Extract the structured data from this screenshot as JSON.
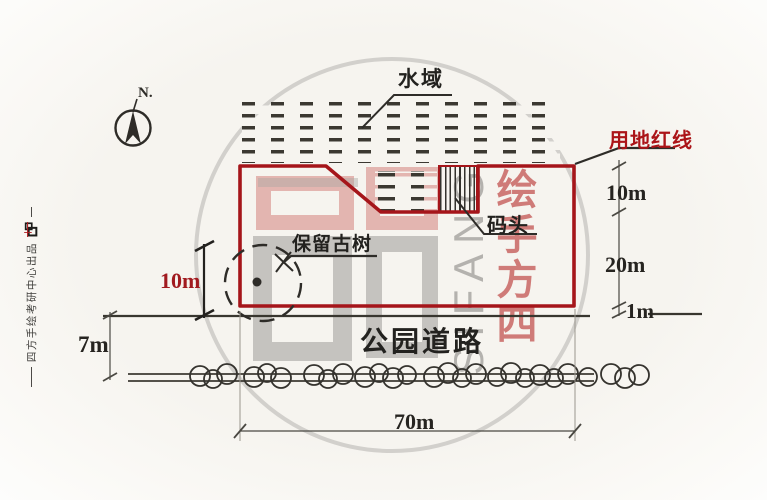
{
  "canvas": {
    "width": 767,
    "height": 500
  },
  "compass": {
    "north_label": "N."
  },
  "plan_labels": {
    "water_area": "水域",
    "site_red_line": "用地红线",
    "dock": "码头",
    "preserved_ancient_tree": "保留古树",
    "park_road": "公园道路"
  },
  "dimensions": {
    "right_upper": "10m",
    "right_middle": "20m",
    "right_lower": "1m",
    "tree_offset": "10m",
    "road_width": "7m",
    "site_frontage": "70m"
  },
  "watermark": {
    "brand_en": "SIFANG",
    "column_display": "绘手方四"
  },
  "side_mark": {
    "producer_text": "四方手绘考研中心出品"
  },
  "colors": {
    "red_line": "#a5151a",
    "red_label": "#ab1418",
    "red_dim": "#a11a1f",
    "ink": "#2e2c28",
    "watermark_gray": "#b9b6b1",
    "watermark_pink": "#dba39e",
    "watermark_red": "#c24a45"
  }
}
